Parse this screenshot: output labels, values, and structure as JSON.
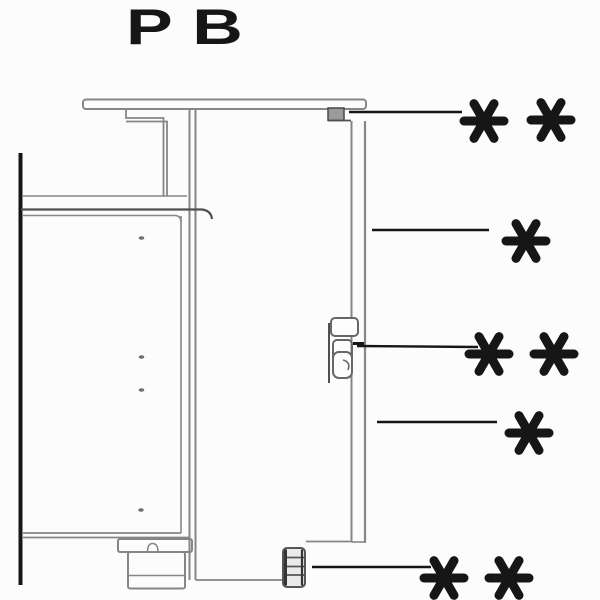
{
  "title": {
    "label": "PB"
  },
  "colors": {
    "background": "#fcfcfc",
    "ink": "#161616",
    "line": "#868686",
    "line_dark": "#4f4f4f",
    "block_fill": "#9a9a9a",
    "bracket_fill": "#eaeaea",
    "panel_fill": "#fdfdfd"
  },
  "asterisk_style": {
    "radius": 20,
    "stroke_width": 9,
    "spoke_angles": [
      0,
      60,
      120
    ]
  },
  "callouts": [
    {
      "name": "callout-top-mount",
      "symbol": "* *",
      "leader": {
        "x1": 349,
        "y1": 112,
        "x2": 462,
        "y2": 112
      },
      "marks": [
        {
          "cx": 484,
          "cy": 121
        },
        {
          "cx": 551,
          "cy": 120
        }
      ]
    },
    {
      "name": "callout-door-upper",
      "symbol": "*",
      "leader": {
        "x1": 372,
        "y1": 230,
        "x2": 489,
        "y2": 230
      },
      "marks": [
        {
          "cx": 526,
          "cy": 241
        }
      ]
    },
    {
      "name": "callout-mid-bracket",
      "symbol": "* *",
      "leader": {
        "x1": 357,
        "y1": 346,
        "x2": 478,
        "y2": 347
      },
      "marks": [
        {
          "cx": 489,
          "cy": 354
        },
        {
          "cx": 554,
          "cy": 354
        }
      ]
    },
    {
      "name": "callout-door-lower",
      "symbol": "*",
      "leader": {
        "x1": 377,
        "y1": 422,
        "x2": 497,
        "y2": 422
      },
      "marks": [
        {
          "cx": 529,
          "cy": 433
        }
      ]
    },
    {
      "name": "callout-bottom-fitting",
      "symbol": "* *",
      "leader": {
        "x1": 312,
        "y1": 567,
        "x2": 431,
        "y2": 567
      },
      "marks": [
        {
          "cx": 444,
          "cy": 578
        },
        {
          "cx": 509,
          "cy": 578
        }
      ]
    }
  ]
}
